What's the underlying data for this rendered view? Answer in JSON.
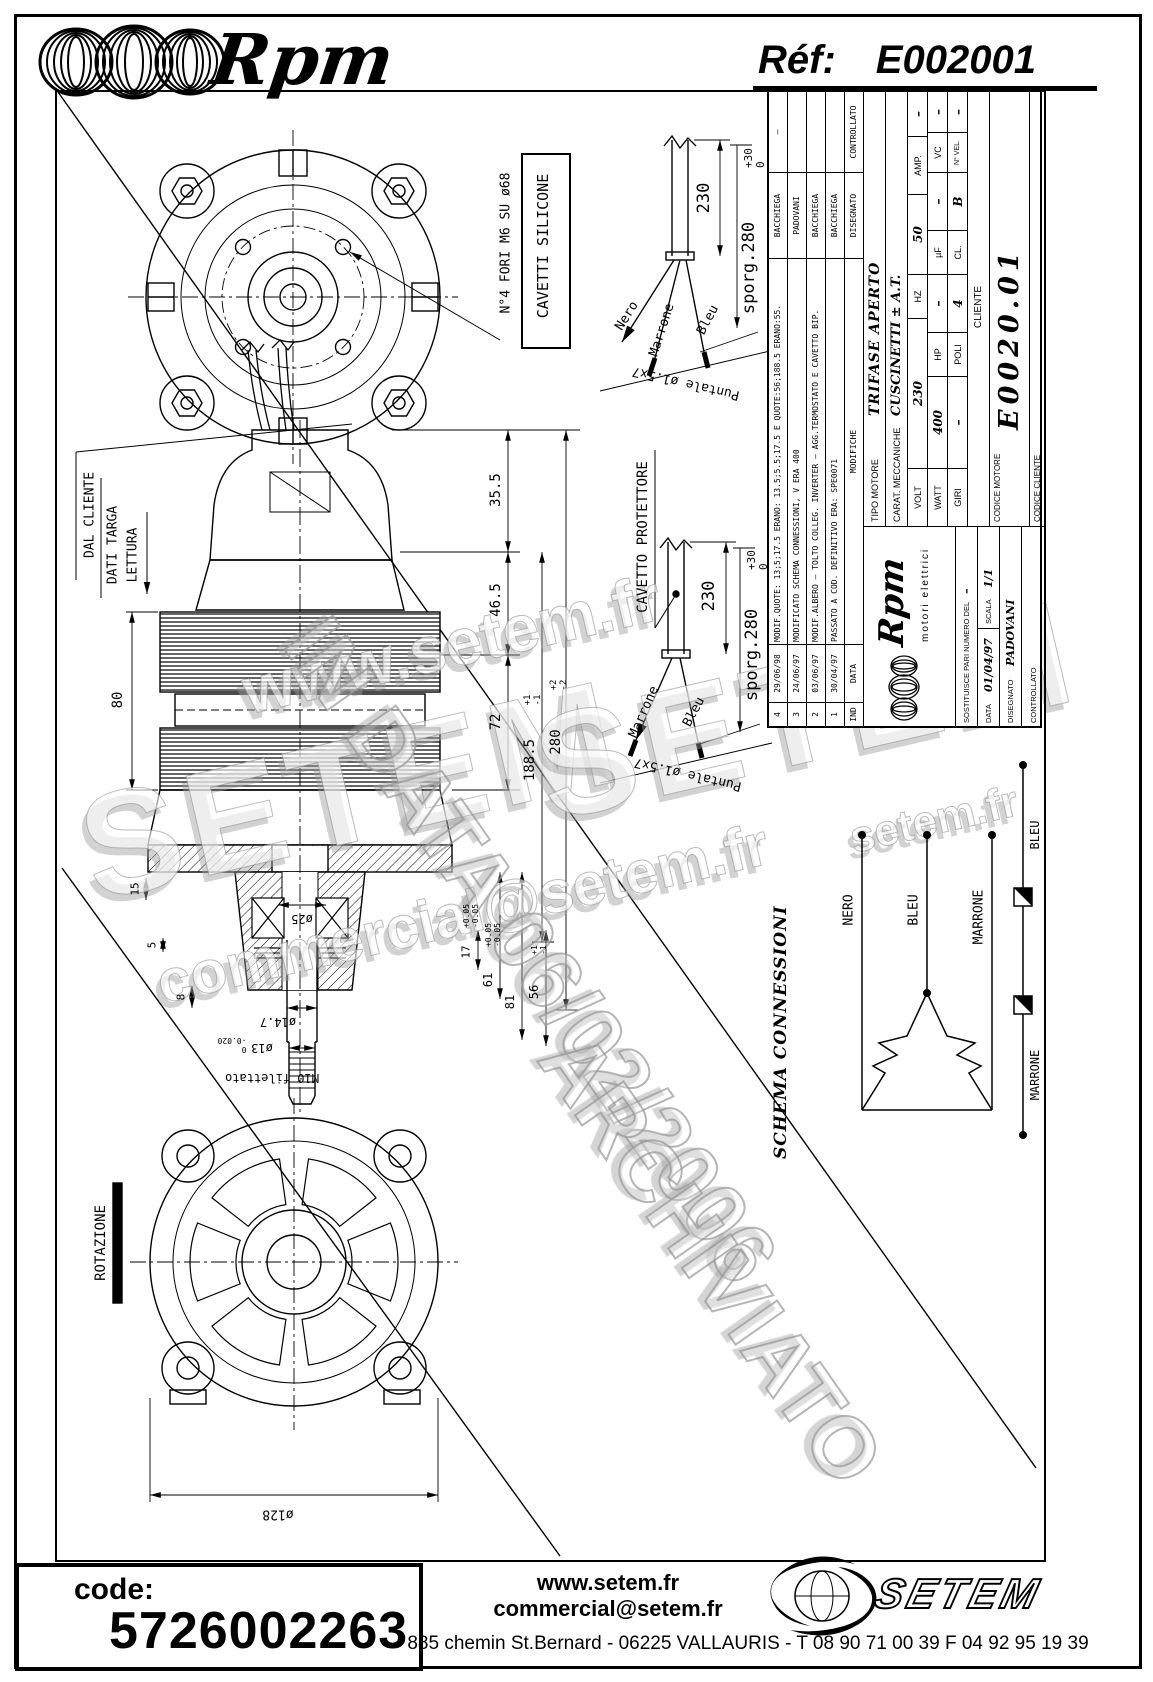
{
  "page": {
    "brand": "Rpm",
    "ref_label": "Réf:",
    "ref_value": "E002001"
  },
  "watermarks": {
    "wm1": "www.setem.fr",
    "wm2": "SETEM",
    "wm3": "SETEM",
    "wm4": "commercial@setem.fr",
    "wm5": "setem.fr",
    "stamp_line1": "IN DATA 06/02/2006",
    "stamp_line2": "ARCHIVIATO"
  },
  "flange_view": {
    "holes_note": "N°4 FORI M6 SU ø68",
    "cable_note": "CAVETTI SILICONE"
  },
  "section_view": {
    "labels": {
      "dal_cliente": "DAL CLIENTE",
      "dati_targa": "DATI TARGA",
      "lettura": "LETTURA",
      "m10": "M10 filettato"
    },
    "dims": {
      "d355": "35.5",
      "d465": "46.5",
      "d72": "72",
      "d1885": "188.5",
      "d1885_tol": "+1\n-1",
      "d280": "280",
      "d280_tol": "+2\n-2",
      "d80": "80",
      "d15": "15",
      "d5": "5",
      "d8": "8",
      "d17": "17",
      "d17_tol": "+0.05\n-0.05",
      "d61": "61",
      "d61_tol": "+0.05\n-0.05",
      "d81": "81",
      "d56": "56",
      "d56_tol": "+1\n-1",
      "d25": "ø25",
      "d147": "ø14.7",
      "d13": "ø13",
      "d13_tol": "0\n-0.020"
    }
  },
  "fan_view": {
    "rotation": "ROTAZIONE",
    "d128": "ø128"
  },
  "cable1": {
    "dim230": "230",
    "sporg": "sporg.280",
    "sporg_tol": "+30\n 0",
    "w1": "Nero",
    "w2": "Marrone",
    "w3": "Bleu",
    "puntale": "Puntale ø1.5x7"
  },
  "cable2": {
    "title": "CAVETTO PROTETTORE",
    "dim230": "230",
    "sporg": "sporg.280",
    "sporg_tol": "+30\n 0",
    "w1": "Marrone",
    "w2": "Bleu",
    "puntale": "Puntale ø1.5x7"
  },
  "title_block": {
    "mod_header": {
      "ind": "IND",
      "data": "DATA",
      "mod": "MODIFICHE",
      "dis": "DISEGNATO",
      "ctrl": "CONTROLLATO"
    },
    "mods": [
      {
        "ind": "4",
        "date": "29/06/98",
        "text": "MODIF.QUOTE: 13;5;17.5 ERANO: 13.5;5.5;17.5 E QUOTE:56;188.5 ERANO:55.",
        "dis": "BACCHIEGA",
        "ctrl": "–"
      },
      {
        "ind": "3",
        "date": "24/06/97",
        "text": "MODIFICATO SCHEMA CONNESSIONI, V ERA 400",
        "dis": "PADOVANI",
        "ctrl": ""
      },
      {
        "ind": "2",
        "date": "03/06/97",
        "text": "MODIF.ALBERO – TOLTO COLLEG. INVERTER – AGG.TERMOSTATO E CAVETTO BIP.",
        "dis": "BACCHIEGA",
        "ctrl": ""
      },
      {
        "ind": "1",
        "date": "30/04/97",
        "text": "PASSATO A COD. DEFINITIVO ERA: SPE0071",
        "dis": "BACCHIEGA",
        "ctrl": ""
      }
    ],
    "logo_brand": "Rpm",
    "logo_sub": "motori elettrici",
    "sost_label": "SOSTITUISCE PARI NUMERO DEL",
    "sost_value": "–",
    "data_label": "DATA",
    "data_value": "01/04/97",
    "scala_label": "SCALA",
    "scala_value": "1/1",
    "disegnato_label": "DISEGNATO",
    "disegnato_value": "PADOVANI",
    "controllato_label": "CONTROLLATO",
    "tipo_label": "TIPO MOTORE",
    "tipo_value": "TRIFASE APERTO",
    "carat_label": "CARAT. MECCANICHE",
    "carat_value": "CUSCINETTI ± A.T.",
    "elec": [
      {
        "l": "VOLT",
        "v": "230"
      },
      {
        "l": "HZ",
        "v": "50"
      },
      {
        "l": "AMP.",
        "v": "–"
      },
      {
        "l": "WATT",
        "v": "400"
      },
      {
        "l": "HP",
        "v": "–"
      },
      {
        "l": "µF",
        "v": "–"
      },
      {
        "l": "VC",
        "v": "–"
      },
      {
        "l": "GIRI",
        "v": "–"
      },
      {
        "l": "POLI",
        "v": "4"
      },
      {
        "l": "CL.",
        "v": "B"
      },
      {
        "l": "N° VEL.",
        "v": "–"
      }
    ],
    "cliente_label": "CLIENTE",
    "codice_motore_label": "CODICE MOTORE",
    "codice_motore_value": "E0020.01",
    "codice_cliente_label": "CODICE CLIENTE"
  },
  "schema": {
    "title": "SCHEMA CONNESSIONI",
    "wire1": "NERO",
    "wire2": "BLEU",
    "wire3": "MARRONE",
    "prot_left": "MARRONE",
    "prot_right": "BLEU"
  },
  "footer": {
    "code_label": "code:",
    "code_value": "5726002263",
    "website": "www.setem.fr",
    "email": "commercial@setem.fr",
    "address": "885 chemin St.Bernard  -  06225 VALLAURIS  -  T 08 90 71 00 39   F 04 92 95 19 39",
    "logo_text": "SETEM"
  }
}
